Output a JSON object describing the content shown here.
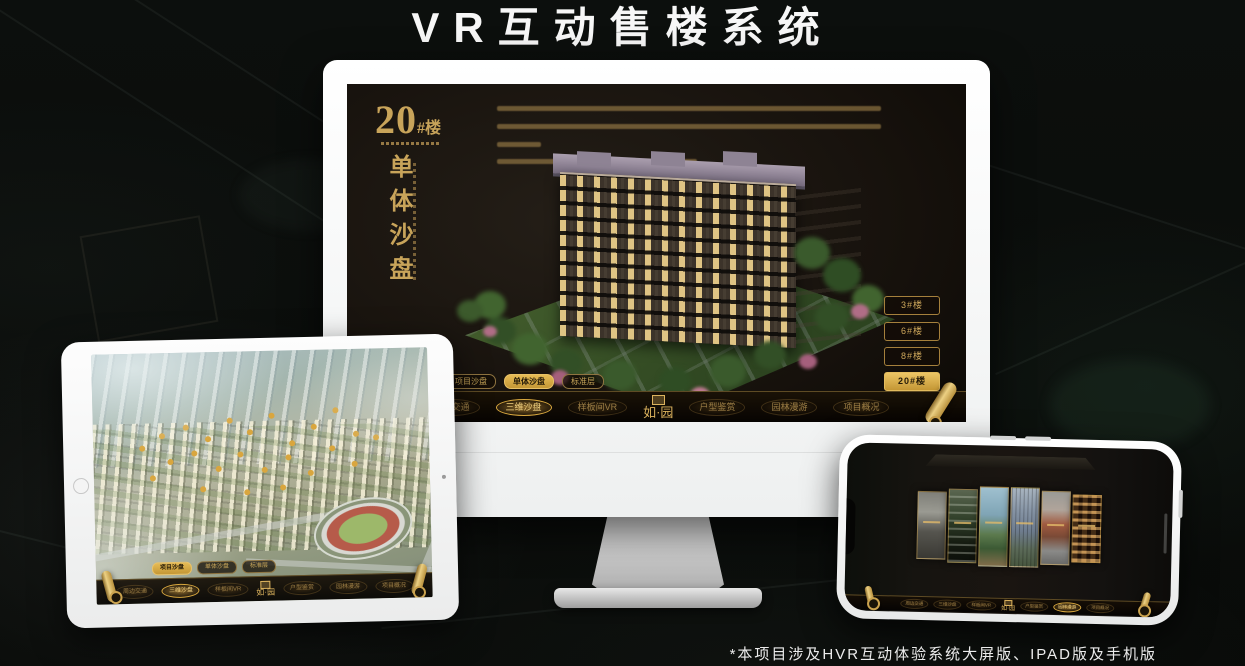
{
  "page": {
    "title": "VR互动售楼系统",
    "footnote": "*本项目涉及HVR互动体验系统大屏版、IPAD版及手机版"
  },
  "colors": {
    "gold": "#c9a14e",
    "gold_bright": "#e6bb55",
    "screen_background": "#16110c"
  },
  "monitor": {
    "headline": {
      "number": "20",
      "suffix": "#楼",
      "vertical": "单体沙盘"
    },
    "floor_buttons": [
      {
        "label": "3#楼",
        "active": false
      },
      {
        "label": "6#楼",
        "active": false
      },
      {
        "label": "8#楼",
        "active": false
      },
      {
        "label": "20#楼",
        "active": true
      }
    ],
    "tabs": [
      {
        "label": "项目沙盘",
        "active": false
      },
      {
        "label": "单体沙盘",
        "active": true
      },
      {
        "label": "标准层",
        "active": false
      }
    ],
    "nav": {
      "logo": "如·园",
      "items": [
        {
          "label": "周边交通",
          "active": false
        },
        {
          "label": "三维沙盘",
          "active": true
        },
        {
          "label": "样板间VR",
          "active": false
        },
        {
          "label": "户型鉴赏",
          "active": false
        },
        {
          "label": "园林漫游",
          "active": false
        },
        {
          "label": "项目概况",
          "active": false
        }
      ]
    }
  },
  "tablet": {
    "tabs": [
      {
        "label": "项目沙盘",
        "active": true
      },
      {
        "label": "单体沙盘",
        "active": false
      },
      {
        "label": "标准层",
        "active": false
      }
    ],
    "nav": {
      "logo": "如·园",
      "items": [
        {
          "label": "周边交通",
          "active": false
        },
        {
          "label": "三维沙盘",
          "active": true
        },
        {
          "label": "样板间VR",
          "active": false
        },
        {
          "label": "户型鉴赏",
          "active": false
        },
        {
          "label": "园林漫游",
          "active": false
        },
        {
          "label": "项目概况",
          "active": false
        }
      ]
    }
  },
  "phone": {
    "nav": {
      "logo": "如·园",
      "items": [
        {
          "label": "周边交通",
          "active": false
        },
        {
          "label": "三维沙盘",
          "active": false
        },
        {
          "label": "样板间VR",
          "active": false
        },
        {
          "label": "户型鉴赏",
          "active": false
        },
        {
          "label": "园林漫游",
          "active": true
        },
        {
          "label": "项目概况",
          "active": false
        }
      ]
    }
  }
}
